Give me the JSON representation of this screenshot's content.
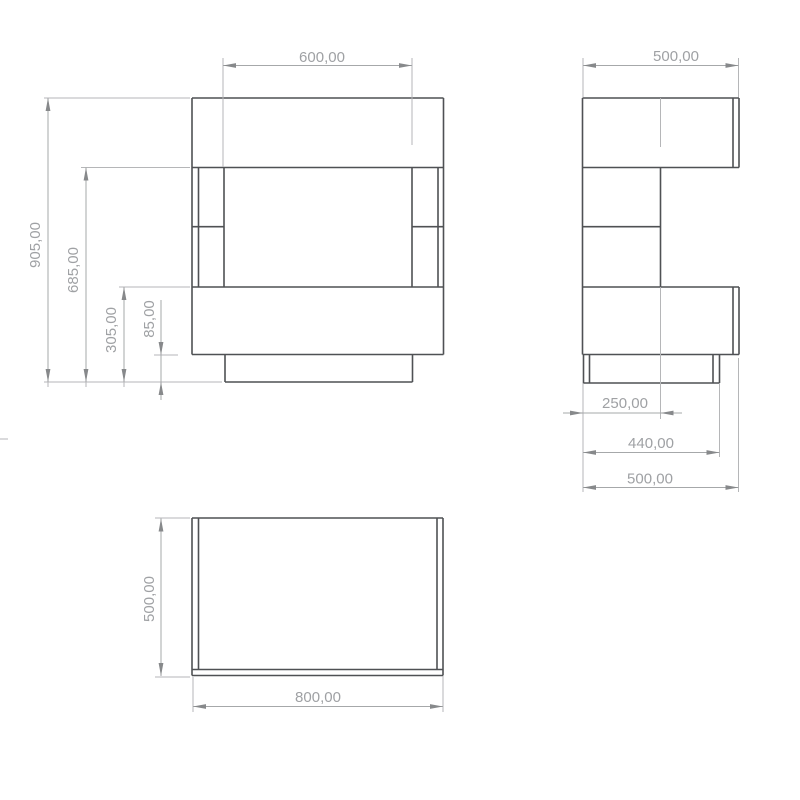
{
  "drawing": {
    "title": "furniture-orthographic-views",
    "units": "mm",
    "background": "#ffffff",
    "body_color": "#4f5154",
    "body_stroke_width": 1.6,
    "ext_color": "#b5b6b8",
    "ext_stroke_width": 1,
    "dim_color": "#a6a8aa",
    "dim_stroke_width": 1,
    "arrow_color": "#87898b",
    "text_color": "#9fa1a4",
    "text_size": 15,
    "arrow_length": 13,
    "arrow_half_width": 2.4,
    "views": [
      {
        "id": "front-view",
        "description": "front elevation, overall 800 wide x 905 high, 600 opening, 85 plinth",
        "lines": [
          [
            192,
            98,
            443.5,
            98
          ],
          [
            192,
            167.5,
            443.5,
            167.5
          ],
          [
            192,
            287,
            443.5,
            287
          ],
          [
            192,
            354.5,
            443.5,
            354.5
          ],
          [
            192,
            98,
            192,
            354.5
          ],
          [
            443.5,
            98,
            443.5,
            354.5
          ],
          [
            198.5,
            167.5,
            198.5,
            287
          ],
          [
            224,
            167.5,
            224,
            287
          ],
          [
            412,
            167.5,
            412,
            287
          ],
          [
            438,
            167.5,
            438,
            287
          ],
          [
            192,
            226.7,
            224,
            226.7
          ],
          [
            412,
            226.7,
            443.5,
            226.7
          ],
          [
            225,
            354.5,
            225,
            382
          ],
          [
            412.5,
            354.5,
            412.5,
            382
          ],
          [
            225,
            382,
            412.5,
            382
          ]
        ]
      },
      {
        "id": "side-view",
        "description": "side elevation, 500 deep x 905 high, 440 base, 250 back panel",
        "lines": [
          [
            582.5,
            98,
            739,
            98
          ],
          [
            582.5,
            167.5,
            739,
            167.5
          ],
          [
            582.5,
            287,
            739,
            287
          ],
          [
            582.5,
            354.5,
            739,
            354.5
          ],
          [
            582.5,
            98,
            582.5,
            354.5
          ],
          [
            739,
            98,
            739,
            167.5
          ],
          [
            733,
            98,
            733,
            167.5
          ],
          [
            739,
            287,
            739,
            354.5
          ],
          [
            733,
            287,
            733,
            354.5
          ],
          [
            660.5,
            167.5,
            660.5,
            287
          ],
          [
            582.5,
            226.7,
            660.5,
            226.7
          ],
          [
            583.5,
            354.5,
            583.5,
            383
          ],
          [
            589.5,
            354.5,
            589.5,
            383
          ],
          [
            713,
            354.5,
            713,
            383
          ],
          [
            719.5,
            354.5,
            719.5,
            383
          ],
          [
            583.5,
            383,
            719.5,
            383
          ]
        ]
      },
      {
        "id": "top-view",
        "description": "plan view, 800 wide x 500 deep",
        "lines": [
          [
            192,
            518,
            443,
            518
          ],
          [
            192,
            675.5,
            443,
            675.5
          ],
          [
            192,
            518,
            192,
            675.5
          ],
          [
            443,
            518,
            443,
            675.5
          ],
          [
            198.5,
            518,
            198.5,
            669.5
          ],
          [
            437,
            518,
            437,
            669.5
          ],
          [
            192,
            669.5,
            443,
            669.5
          ]
        ]
      }
    ],
    "extension_lines": [
      [
        44,
        98,
        190,
        98
      ],
      [
        81,
        167.5,
        190,
        167.5
      ],
      [
        119,
        287,
        190,
        287
      ],
      [
        154,
        355,
        178,
        355
      ],
      [
        44,
        382,
        222,
        382
      ],
      [
        223,
        58,
        223,
        167
      ],
      [
        412,
        58,
        412,
        145
      ],
      [
        48,
        382,
        48,
        387
      ],
      [
        86,
        382,
        86,
        387
      ],
      [
        124,
        382,
        124,
        387
      ],
      [
        583,
        58,
        583,
        97
      ],
      [
        738.5,
        58,
        738.5,
        97
      ],
      [
        660.5,
        98,
        660.5,
        147
      ],
      [
        660.5,
        287,
        660.5,
        419
      ],
      [
        583,
        383,
        583,
        492
      ],
      [
        719.5,
        383,
        719.5,
        457
      ],
      [
        738.5,
        358,
        738.5,
        492
      ],
      [
        155,
        518,
        190,
        518
      ],
      [
        155,
        677,
        190,
        677
      ],
      [
        193,
        677,
        193,
        712
      ],
      [
        443,
        676,
        443,
        712
      ],
      [
        0,
        439,
        8,
        439
      ]
    ],
    "dimensions": [
      {
        "id": "front-opening-width",
        "label": "600,00",
        "value": 600,
        "lines": [
          [
            223,
            65.5,
            412,
            65.5
          ]
        ],
        "arrows": [
          {
            "x": 223,
            "y": 65.5,
            "dir": "left"
          },
          {
            "x": 412,
            "y": 65.5,
            "dir": "right"
          }
        ],
        "text": {
          "x": 322,
          "y": 58,
          "rotated": false
        }
      },
      {
        "id": "front-total-height",
        "label": "905,00",
        "value": 905,
        "lines": [
          [
            48,
            98,
            48,
            382
          ]
        ],
        "arrows": [
          {
            "x": 48,
            "y": 98,
            "dir": "up"
          },
          {
            "x": 48,
            "y": 382,
            "dir": "down"
          }
        ],
        "text": {
          "x": 36,
          "y": 245,
          "rotated": true
        }
      },
      {
        "id": "front-height-685",
        "label": "685,00",
        "value": 685,
        "lines": [
          [
            86,
            167.5,
            86,
            382
          ]
        ],
        "arrows": [
          {
            "x": 86,
            "y": 167.5,
            "dir": "up"
          },
          {
            "x": 86,
            "y": 382,
            "dir": "down"
          }
        ],
        "text": {
          "x": 74,
          "y": 270,
          "rotated": true
        }
      },
      {
        "id": "front-height-305",
        "label": "305,00",
        "value": 305,
        "lines": [
          [
            124,
            287,
            124,
            382
          ]
        ],
        "arrows": [
          {
            "x": 124,
            "y": 287,
            "dir": "up"
          },
          {
            "x": 124,
            "y": 382,
            "dir": "down"
          }
        ],
        "text": {
          "x": 112,
          "y": 330,
          "rotated": true
        }
      },
      {
        "id": "front-plinth-height",
        "label": "85,00",
        "value": 85,
        "lines": [
          [
            161,
            300,
            161,
            355
          ],
          [
            161,
            355,
            161,
            382
          ],
          [
            161,
            382,
            161,
            400
          ]
        ],
        "arrows": [
          {
            "x": 161,
            "y": 355,
            "dir": "down"
          },
          {
            "x": 161,
            "y": 382,
            "dir": "up"
          }
        ],
        "text": {
          "x": 150,
          "y": 319,
          "rotated": true
        }
      },
      {
        "id": "side-depth-top",
        "label": "500,00",
        "value": 500,
        "lines": [
          [
            583,
            65.5,
            738.5,
            65.5
          ]
        ],
        "arrows": [
          {
            "x": 583,
            "y": 65.5,
            "dir": "left"
          },
          {
            "x": 738.5,
            "y": 65.5,
            "dir": "right"
          }
        ],
        "text": {
          "x": 676,
          "y": 57,
          "rotated": false
        }
      },
      {
        "id": "side-back-panel-depth",
        "label": "250,00",
        "value": 250,
        "lines": [
          [
            563,
            413,
            583,
            413
          ],
          [
            583,
            413,
            660.5,
            413
          ],
          [
            660.5,
            413,
            682,
            413
          ]
        ],
        "arrows": [
          {
            "x": 583,
            "y": 413,
            "dir": "right"
          },
          {
            "x": 660.5,
            "y": 413,
            "dir": "left"
          }
        ],
        "text": {
          "x": 625,
          "y": 404,
          "rotated": false
        }
      },
      {
        "id": "side-base-depth",
        "label": "440,00",
        "value": 440,
        "lines": [
          [
            583,
            452.5,
            719.5,
            452.5
          ]
        ],
        "arrows": [
          {
            "x": 583,
            "y": 452.5,
            "dir": "left"
          },
          {
            "x": 719.5,
            "y": 452.5,
            "dir": "right"
          }
        ],
        "text": {
          "x": 651,
          "y": 444,
          "rotated": false
        }
      },
      {
        "id": "side-depth-bottom",
        "label": "500,00",
        "value": 500,
        "lines": [
          [
            583,
            487.5,
            738.5,
            487.5
          ]
        ],
        "arrows": [
          {
            "x": 583,
            "y": 487.5,
            "dir": "left"
          },
          {
            "x": 738.5,
            "y": 487.5,
            "dir": "right"
          }
        ],
        "text": {
          "x": 650,
          "y": 479.5,
          "rotated": false
        }
      },
      {
        "id": "top-depth",
        "label": "500,00",
        "value": 500,
        "lines": [
          [
            161,
            518.5,
            161,
            676
          ]
        ],
        "arrows": [
          {
            "x": 161,
            "y": 518.5,
            "dir": "up"
          },
          {
            "x": 161,
            "y": 676,
            "dir": "down"
          }
        ],
        "text": {
          "x": 150,
          "y": 599,
          "rotated": true
        }
      },
      {
        "id": "top-width",
        "label": "800,00",
        "value": 800,
        "lines": [
          [
            193,
            706.5,
            443,
            706.5
          ]
        ],
        "arrows": [
          {
            "x": 193,
            "y": 706.5,
            "dir": "left"
          },
          {
            "x": 443,
            "y": 706.5,
            "dir": "right"
          }
        ],
        "text": {
          "x": 318,
          "y": 698,
          "rotated": false
        }
      }
    ]
  }
}
